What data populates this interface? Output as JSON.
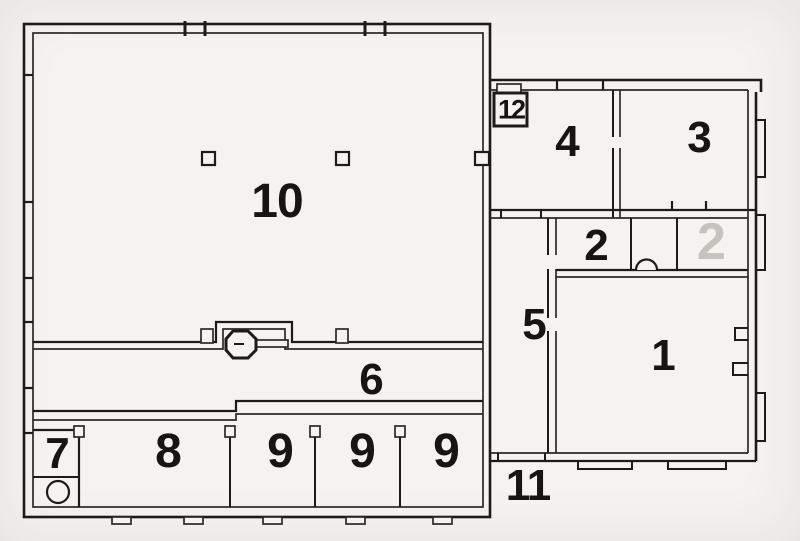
{
  "figure": {
    "kind": "scanned architectural floor plan",
    "colors": {
      "ink": "#1c1b19",
      "paper": "#f4f3ef",
      "muted_label": "#c4c3bd"
    }
  },
  "rooms": [
    {
      "key": "room-10",
      "label": "10"
    },
    {
      "key": "room-6",
      "label": "6"
    },
    {
      "key": "room-7",
      "label": "7"
    },
    {
      "key": "room-8",
      "label": "8"
    },
    {
      "key": "room-9-left",
      "label": "9"
    },
    {
      "key": "room-9-middle",
      "label": "9"
    },
    {
      "key": "room-9-right",
      "label": "9"
    },
    {
      "key": "room-12",
      "label": "12"
    },
    {
      "key": "room-4",
      "label": "4"
    },
    {
      "key": "room-3",
      "label": "3"
    },
    {
      "key": "room-2",
      "label": "2"
    },
    {
      "key": "room-2-muted",
      "label": "2"
    },
    {
      "key": "room-5",
      "label": "5"
    },
    {
      "key": "room-1",
      "label": "1"
    },
    {
      "key": "room-11",
      "label": "11"
    }
  ]
}
